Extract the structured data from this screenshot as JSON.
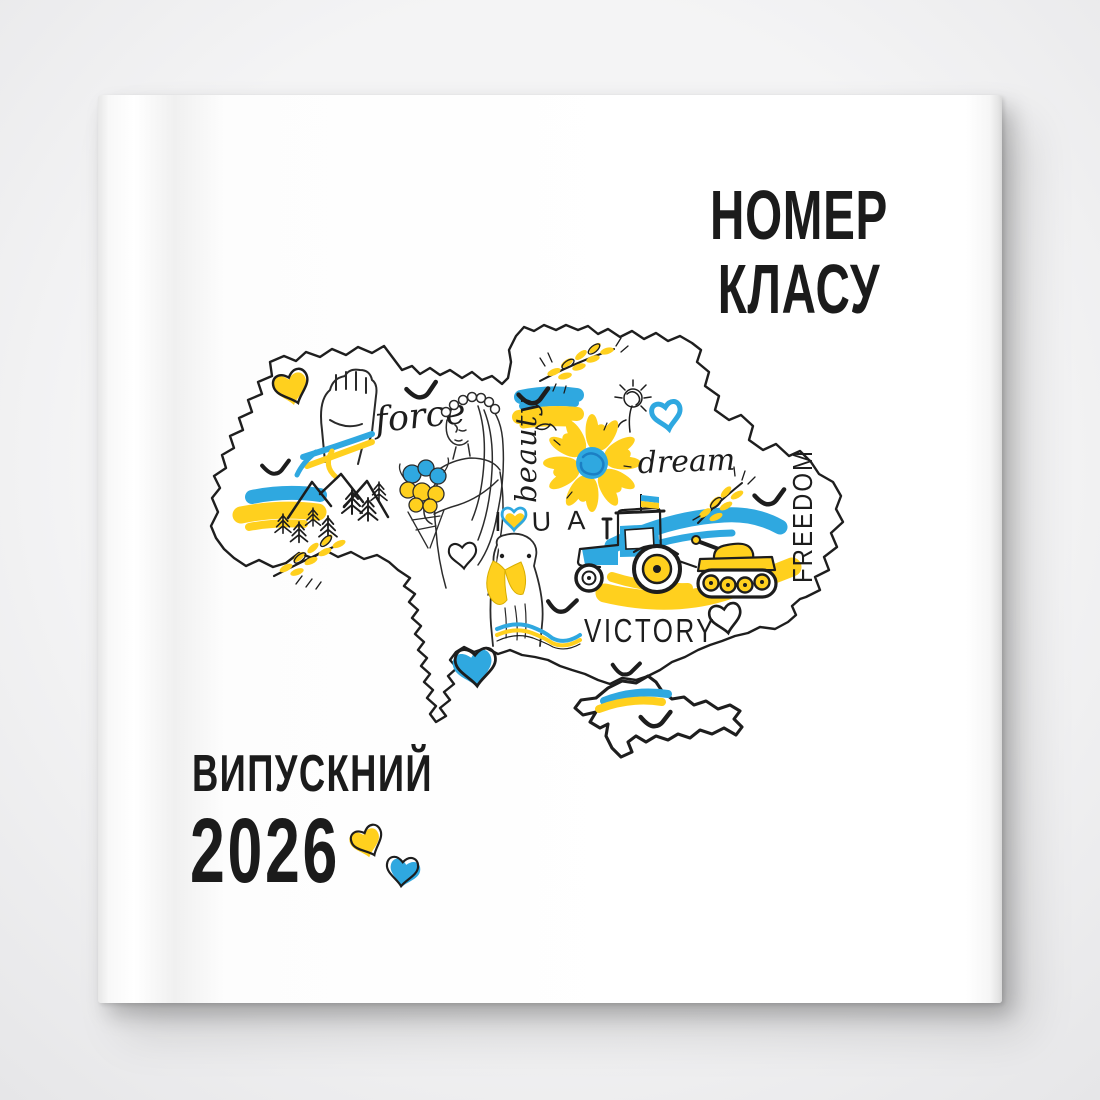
{
  "backdrop_color": "#ECECEE",
  "cover": {
    "paper_color": "#FFFFFF",
    "title_line1": "НОМЕР",
    "title_line2": "КЛАСУ",
    "footer_label": "ВИПУСКНИЙ",
    "footer_year": "2026"
  },
  "art": {
    "words": {
      "force": "force",
      "beauty": "beauty",
      "dream": "dream",
      "i": "I",
      "ua": "U A",
      "victory": "VICTORY",
      "freedom": "FREEDOM"
    },
    "colors": {
      "blue": "#2FA8E0",
      "yellow": "#FFD01E",
      "ink": "#1D1D1D"
    }
  }
}
